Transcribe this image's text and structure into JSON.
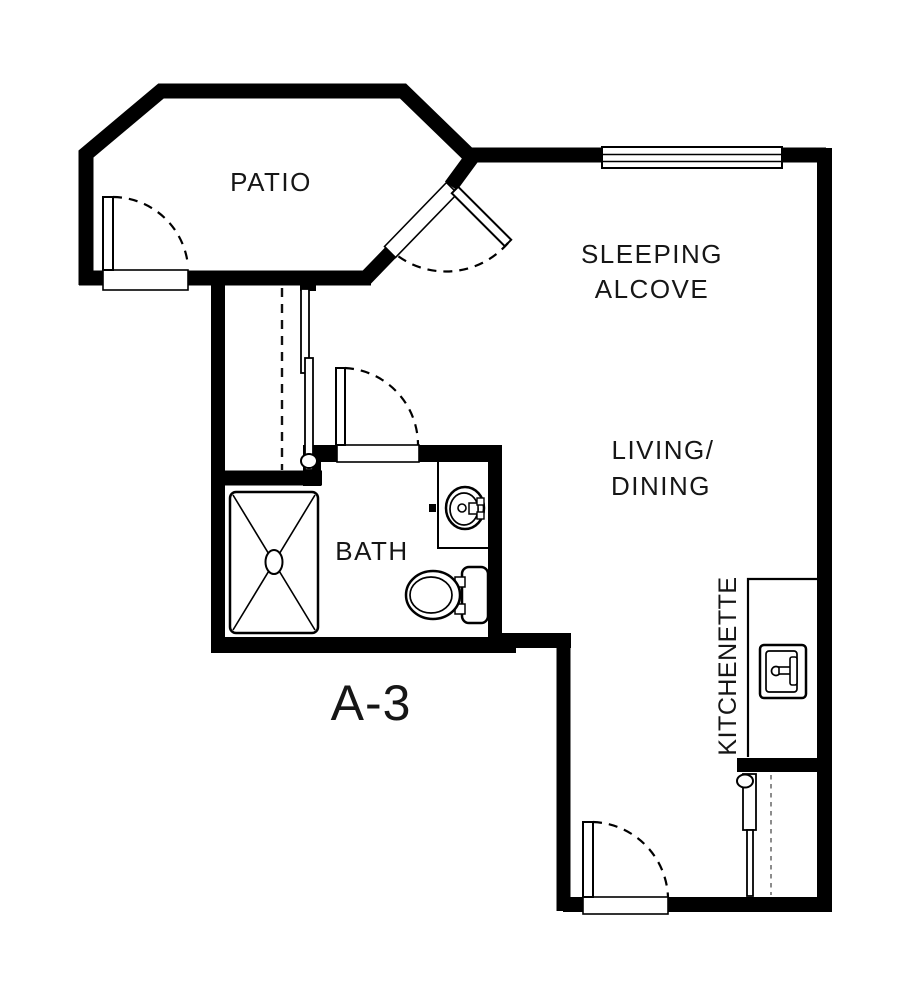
{
  "unit": {
    "label": "A-3"
  },
  "rooms": {
    "patio": {
      "label": "PATIO"
    },
    "sleeping_alcove": {
      "line1": "SLEEPING",
      "line2": "ALCOVE"
    },
    "living_dining": {
      "line1": "LIVING/",
      "line2": "DINING"
    },
    "bath": {
      "label": "BATH"
    },
    "kitchenette": {
      "label": "KITCHENETTE"
    }
  },
  "fixtures": [
    "shower",
    "vanity-sink",
    "toilet",
    "kitchen-sink",
    "closet-sliding-doors",
    "entry-closet-sliding-doors"
  ],
  "openings": [
    "patio-left-door",
    "patio-angled-door",
    "bath-door",
    "entry-door",
    "alcove-window"
  ],
  "colors": {
    "wall": "#000000",
    "background": "#ffffff",
    "text": "#161616"
  }
}
